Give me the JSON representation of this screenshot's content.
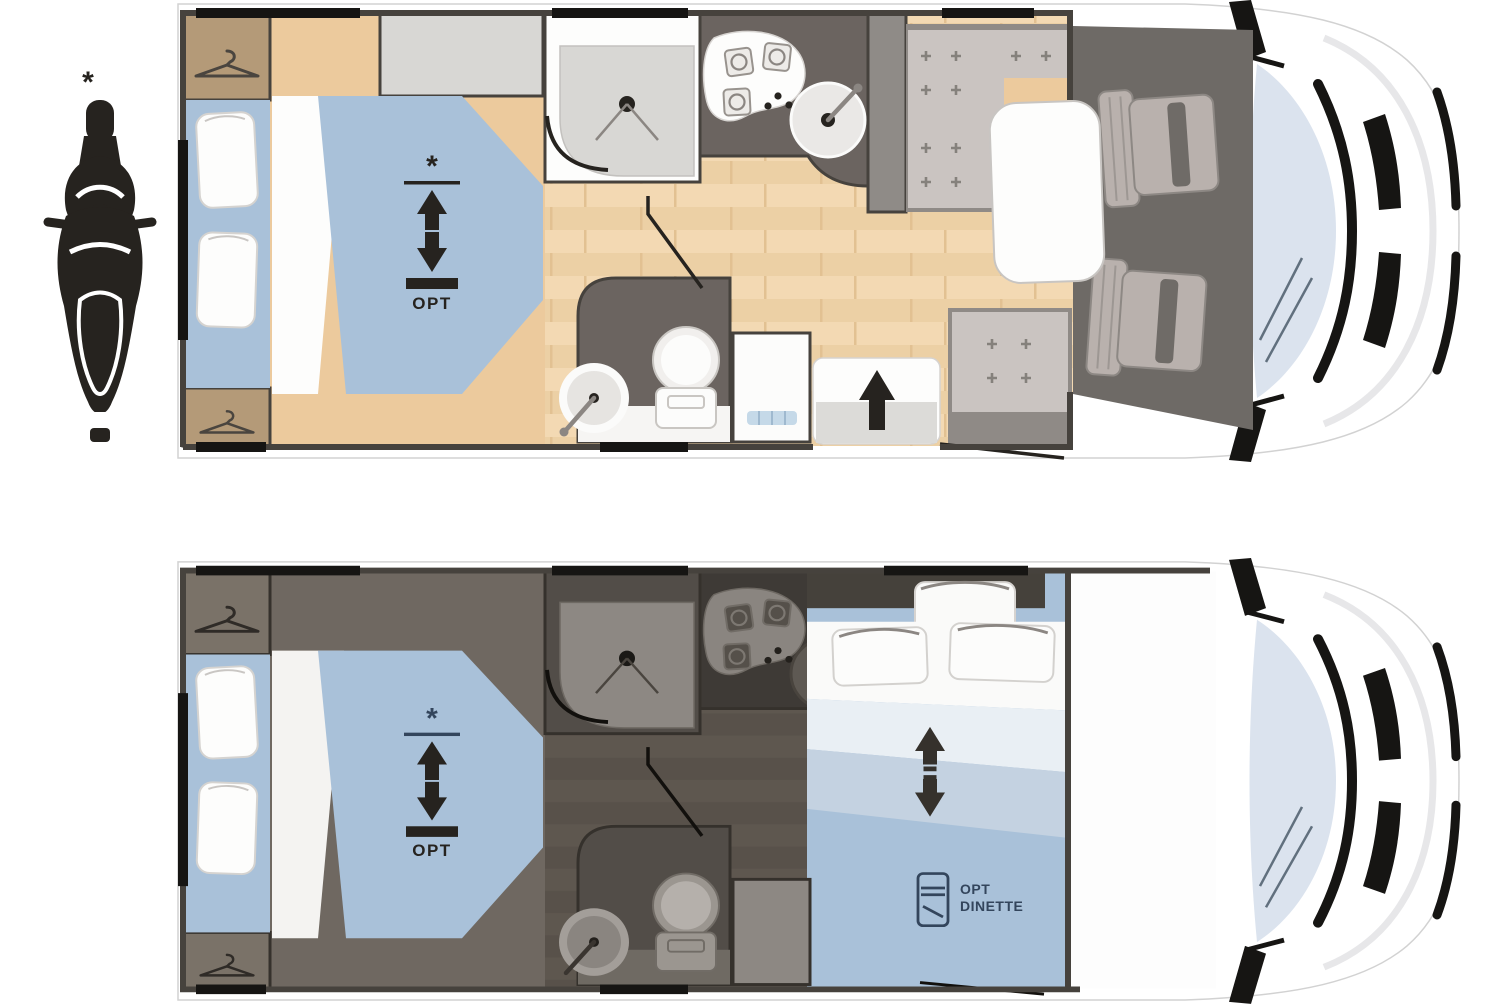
{
  "diagram": {
    "description": "Motorhome floor plans, day layout (top) and night layout (bottom), with scooter garage icon",
    "scooter_asterisk": "*"
  },
  "plans": {
    "day": {
      "id": "day-layout",
      "drop_down_bed": {
        "asterisk": "*",
        "opt_label": "OPT"
      }
    },
    "night": {
      "id": "night-layout",
      "drop_down_bed": {
        "asterisk": "*",
        "opt_label": "OPT"
      },
      "dinette_bed": {
        "opt_line1": "OPT",
        "opt_line2": "DINETTE"
      }
    }
  },
  "colors": {
    "ink": "#26231f",
    "wall": "#46423d",
    "win": "#161513",
    "shield": "#dbe3ee",
    "wood_a": "#f3d9b3",
    "wood_b": "#ecd0a5",
    "wood_line": "#e2c192",
    "tan": "#b49a78",
    "beige": "#ecca9d",
    "blue": "#a9c1d9",
    "gray": "#d8d7d4",
    "seat": "#cac4c1",
    "seat_base": "#8f8a86",
    "counter": "#6b6460",
    "cab": "#6e6a66",
    "cab_seat": "#b9b1ad",
    "night_floor_a": "#5e574f",
    "night_floor_b": "#58514a",
    "night_room": "#524d48",
    "night_bedroom": "#6f6861",
    "night_wardrobe": "#7a7268",
    "night_fix": "#8d8883",
    "night_stove": "#3e3a36",
    "heater": "#c5d9e8",
    "navy": "#33455c",
    "step": "#dcdbd8",
    "sheet": "#fafaf9",
    "duvet_pale": "#e9eff4",
    "blue_mid": "#c4d2e1"
  }
}
